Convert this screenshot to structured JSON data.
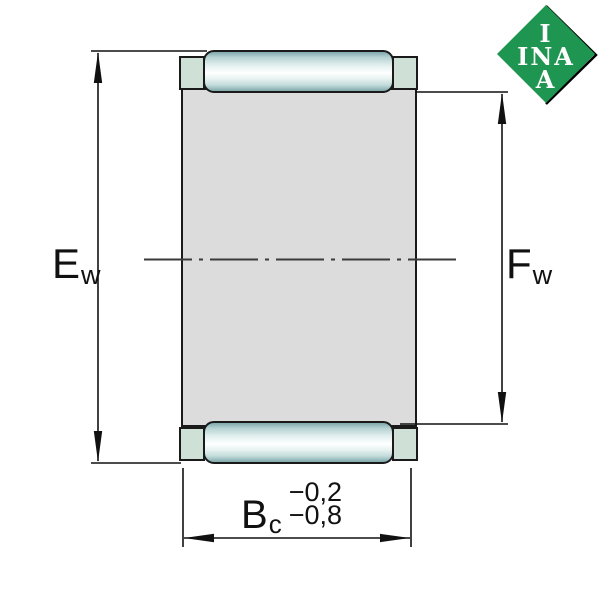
{
  "drawing": {
    "type": "needle-roller-and-cage-assembly-cross-section",
    "dimensions": {
      "left": {
        "symbol": "E",
        "subscript": "w"
      },
      "right": {
        "symbol": "F",
        "subscript": "w"
      },
      "bottom": {
        "symbol": "B",
        "subscript": "c",
        "tolerance_upper": "−0,2",
        "tolerance_lower": "−0,8"
      }
    }
  },
  "logo": {
    "line1": "I",
    "line2": "INA",
    "line3": "A"
  },
  "colors": {
    "body_fill": "#dcdcdc",
    "cage_fill": "#cfe0d7",
    "roller_dark": "#7fa9ac",
    "roller_light": "#ffffff",
    "outline": "#1a1a1a",
    "logo_green": "#1E9550",
    "line_color": "#111111"
  }
}
